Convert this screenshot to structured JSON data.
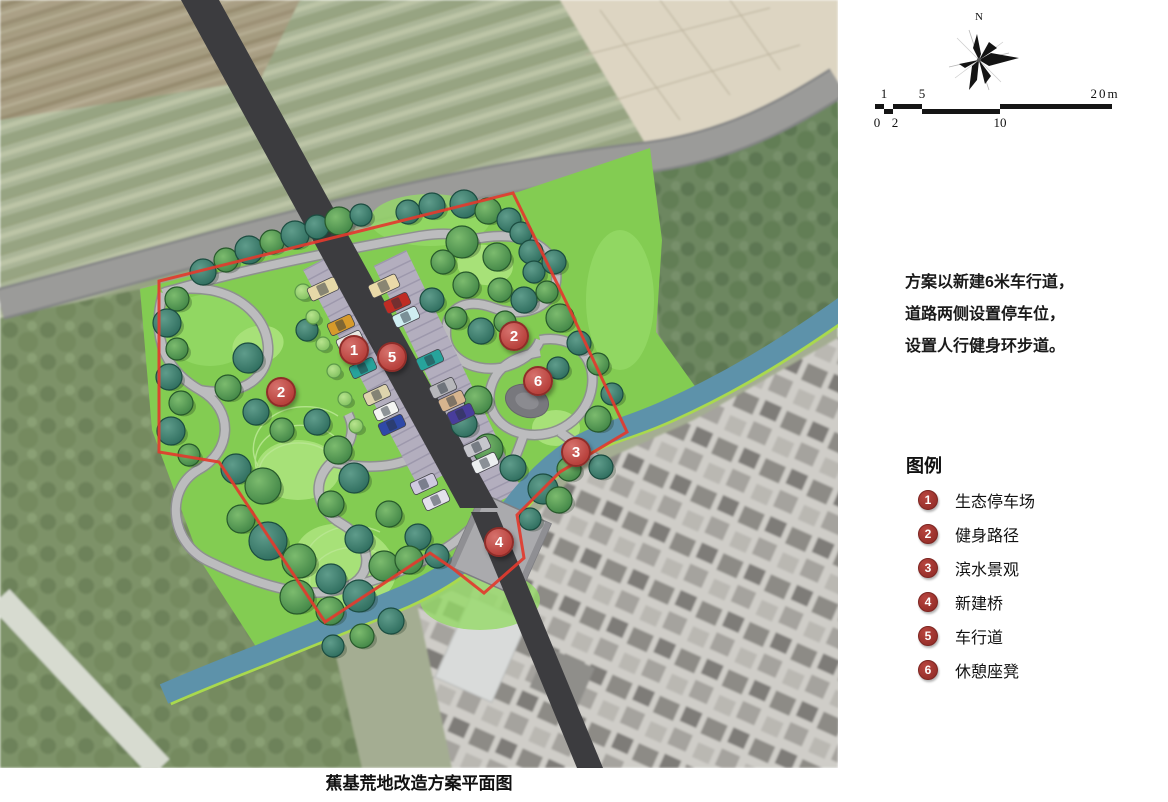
{
  "map": {
    "boundary_color": "#e23b2e",
    "marker_color": "#c4524e",
    "river_color": "#5d92aa",
    "park_green": "#83cc52",
    "markers": [
      {
        "label": "1",
        "x": 354,
        "y": 350
      },
      {
        "label": "5",
        "x": 392,
        "y": 357
      },
      {
        "label": "2",
        "x": 281,
        "y": 392
      },
      {
        "label": "2",
        "x": 514,
        "y": 336
      },
      {
        "label": "6",
        "x": 538,
        "y": 381
      },
      {
        "label": "3",
        "x": 576,
        "y": 452
      },
      {
        "label": "4",
        "x": 499,
        "y": 542
      }
    ],
    "trees": [
      [
        203,
        272,
        13,
        "t"
      ],
      [
        226,
        260,
        12,
        "g"
      ],
      [
        249,
        250,
        14,
        "t"
      ],
      [
        272,
        242,
        12,
        "g"
      ],
      [
        295,
        235,
        14,
        "t"
      ],
      [
        317,
        227,
        12,
        "t"
      ],
      [
        339,
        221,
        14,
        "g"
      ],
      [
        361,
        215,
        11,
        "t"
      ],
      [
        408,
        212,
        12,
        "t"
      ],
      [
        432,
        206,
        13,
        "t"
      ],
      [
        464,
        204,
        14,
        "t"
      ],
      [
        488,
        211,
        13,
        "g"
      ],
      [
        509,
        220,
        12,
        "t"
      ],
      [
        521,
        233,
        11,
        "t"
      ],
      [
        462,
        242,
        16,
        "g"
      ],
      [
        497,
        257,
        14,
        "g"
      ],
      [
        531,
        252,
        12,
        "t"
      ],
      [
        534,
        272,
        11,
        "t"
      ],
      [
        554,
        262,
        12,
        "t"
      ],
      [
        466,
        285,
        13,
        "g"
      ],
      [
        500,
        290,
        12,
        "g"
      ],
      [
        524,
        300,
        13,
        "t"
      ],
      [
        547,
        292,
        11,
        "g"
      ],
      [
        443,
        262,
        12,
        "g"
      ],
      [
        432,
        300,
        12,
        "t"
      ],
      [
        456,
        318,
        11,
        "g"
      ],
      [
        481,
        331,
        13,
        "t"
      ],
      [
        505,
        322,
        11,
        "g"
      ],
      [
        560,
        318,
        14,
        "g"
      ],
      [
        579,
        343,
        12,
        "t"
      ],
      [
        598,
        364,
        11,
        "g"
      ],
      [
        558,
        368,
        11,
        "t"
      ],
      [
        177,
        299,
        12,
        "g"
      ],
      [
        167,
        323,
        14,
        "t"
      ],
      [
        177,
        349,
        11,
        "g"
      ],
      [
        169,
        377,
        13,
        "t"
      ],
      [
        181,
        403,
        12,
        "g"
      ],
      [
        171,
        431,
        14,
        "t"
      ],
      [
        189,
        455,
        11,
        "g"
      ],
      [
        248,
        358,
        15,
        "t"
      ],
      [
        228,
        388,
        13,
        "g"
      ],
      [
        256,
        412,
        13,
        "t"
      ],
      [
        282,
        430,
        12,
        "g"
      ],
      [
        307,
        330,
        11,
        "t"
      ],
      [
        303,
        292,
        8,
        "l"
      ],
      [
        313,
        317,
        7,
        "l"
      ],
      [
        323,
        344,
        7,
        "l"
      ],
      [
        334,
        371,
        7,
        "l"
      ],
      [
        345,
        399,
        7,
        "l"
      ],
      [
        356,
        426,
        7,
        "l"
      ],
      [
        317,
        422,
        13,
        "t"
      ],
      [
        338,
        450,
        14,
        "g"
      ],
      [
        354,
        478,
        15,
        "t"
      ],
      [
        331,
        504,
        13,
        "g"
      ],
      [
        236,
        469,
        15,
        "t"
      ],
      [
        263,
        486,
        18,
        "g"
      ],
      [
        241,
        519,
        14,
        "g"
      ],
      [
        268,
        541,
        19,
        "t"
      ],
      [
        299,
        561,
        17,
        "g"
      ],
      [
        331,
        579,
        15,
        "t"
      ],
      [
        297,
        597,
        17,
        "g"
      ],
      [
        330,
        611,
        14,
        "g"
      ],
      [
        359,
        596,
        16,
        "t"
      ],
      [
        384,
        566,
        15,
        "g"
      ],
      [
        359,
        539,
        14,
        "t"
      ],
      [
        389,
        514,
        13,
        "g"
      ],
      [
        418,
        537,
        13,
        "t"
      ],
      [
        409,
        560,
        14,
        "g"
      ],
      [
        437,
        556,
        12,
        "t"
      ],
      [
        478,
        400,
        14,
        "g"
      ],
      [
        464,
        424,
        13,
        "t"
      ],
      [
        488,
        449,
        15,
        "g"
      ],
      [
        513,
        468,
        13,
        "t"
      ],
      [
        543,
        489,
        15,
        "t"
      ],
      [
        569,
        469,
        12,
        "g"
      ],
      [
        598,
        419,
        13,
        "g"
      ],
      [
        612,
        394,
        11,
        "t"
      ],
      [
        601,
        467,
        12,
        "t"
      ],
      [
        559,
        500,
        13,
        "g"
      ],
      [
        530,
        519,
        11,
        "t"
      ],
      [
        391,
        621,
        13,
        "t"
      ],
      [
        362,
        636,
        12,
        "g"
      ],
      [
        333,
        646,
        11,
        "t"
      ]
    ],
    "cars": [
      {
        "x": 323,
        "y": 289,
        "w": 30,
        "h": 14,
        "c": "#e6d9a8"
      },
      {
        "x": 341,
        "y": 325,
        "w": 26,
        "h": 13,
        "c": "#d79a2b"
      },
      {
        "x": 350,
        "y": 341,
        "w": 26,
        "h": 13,
        "c": "#e9e9e2"
      },
      {
        "x": 363,
        "y": 368,
        "w": 26,
        "h": 13,
        "c": "#27a39b"
      },
      {
        "x": 377,
        "y": 395,
        "w": 26,
        "h": 13,
        "c": "#ded4ad"
      },
      {
        "x": 386,
        "y": 411,
        "w": 24,
        "h": 12,
        "c": "#f4f4f2"
      },
      {
        "x": 392,
        "y": 425,
        "w": 26,
        "h": 13,
        "c": "#2f49a8"
      },
      {
        "x": 424,
        "y": 484,
        "w": 26,
        "h": 13,
        "c": "#cfcadf"
      },
      {
        "x": 436,
        "y": 500,
        "w": 26,
        "h": 13,
        "c": "#e4e1ec"
      },
      {
        "x": 384,
        "y": 286,
        "w": 30,
        "h": 14,
        "c": "#ead9a8"
      },
      {
        "x": 397,
        "y": 303,
        "w": 26,
        "h": 13,
        "c": "#bf2c24"
      },
      {
        "x": 406,
        "y": 317,
        "w": 26,
        "h": 13,
        "c": "#cfeef2"
      },
      {
        "x": 430,
        "y": 360,
        "w": 26,
        "h": 13,
        "c": "#27a39b"
      },
      {
        "x": 443,
        "y": 388,
        "w": 26,
        "h": 13,
        "c": "#b7b7bb"
      },
      {
        "x": 452,
        "y": 401,
        "w": 26,
        "h": 13,
        "c": "#d7b48e"
      },
      {
        "x": 461,
        "y": 414,
        "w": 26,
        "h": 13,
        "c": "#483d9c"
      },
      {
        "x": 477,
        "y": 447,
        "w": 26,
        "h": 13,
        "c": "#c6c6cc"
      },
      {
        "x": 485,
        "y": 463,
        "w": 26,
        "h": 13,
        "c": "#eceff0"
      }
    ]
  },
  "compass": {
    "north_label": "N"
  },
  "scale_bar": {
    "labels_above": [
      "1",
      "5",
      "20m"
    ],
    "labels_below": [
      "0",
      "2",
      "10"
    ]
  },
  "description": {
    "lines": [
      "方案以新建6米车行道，",
      "道路两侧设置停车位，",
      "设置人行健身环步道。"
    ]
  },
  "legend": {
    "title": "图例",
    "items": [
      {
        "num": "1",
        "label": "生态停车场"
      },
      {
        "num": "2",
        "label": "健身路径"
      },
      {
        "num": "3",
        "label": "滨水景观"
      },
      {
        "num": "4",
        "label": "新建桥"
      },
      {
        "num": "5",
        "label": "车行道"
      },
      {
        "num": "6",
        "label": "休憩座凳"
      }
    ]
  },
  "caption": "蕉基荒地改造方案平面图"
}
